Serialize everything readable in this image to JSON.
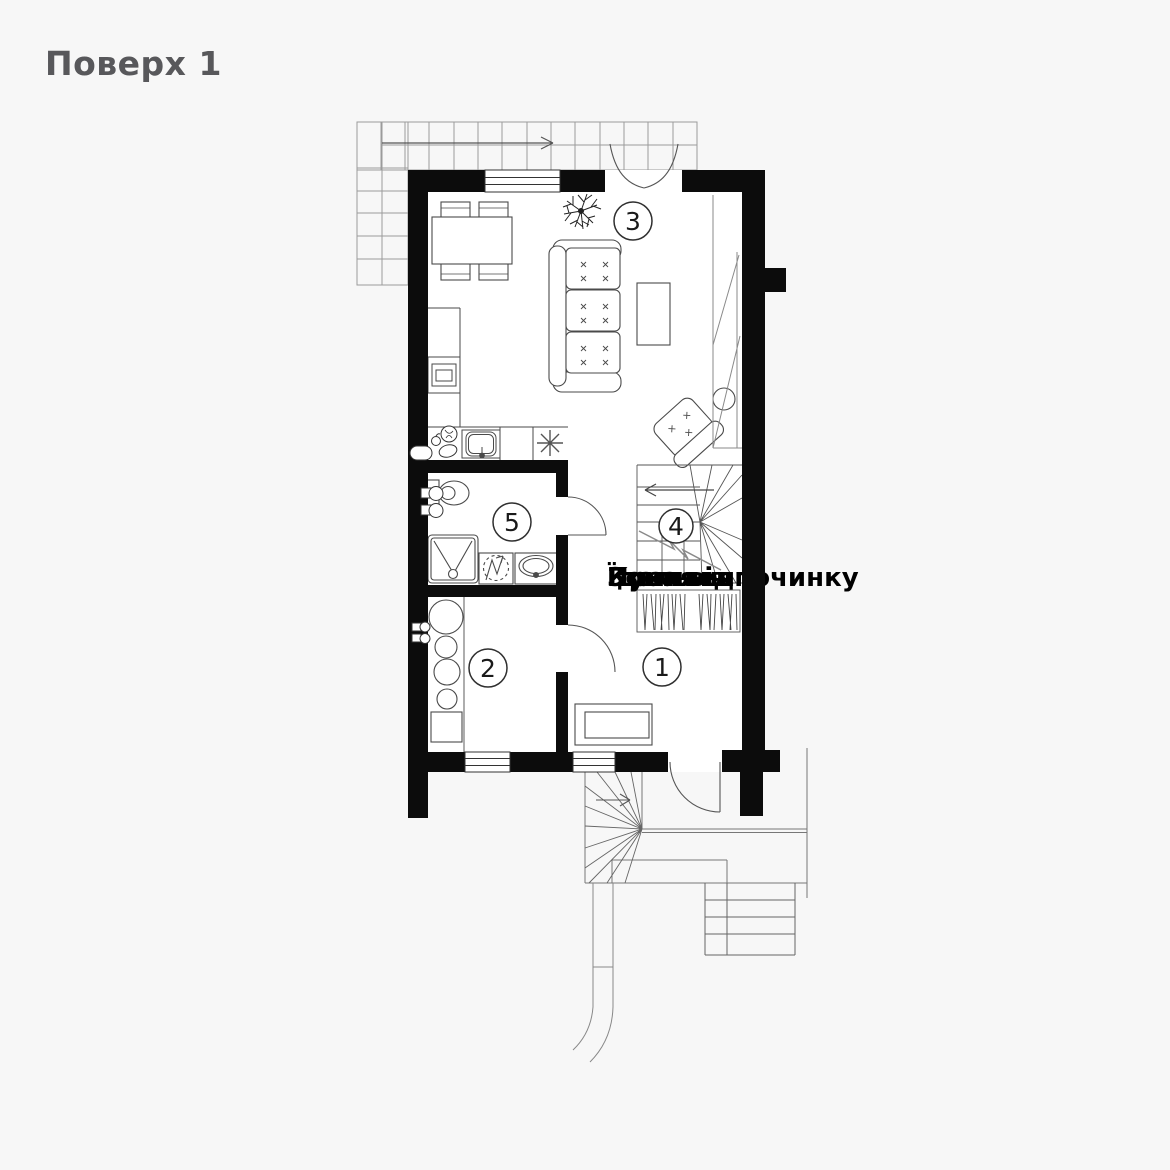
{
  "page": {
    "title": "Поверх 1",
    "background_color": "#f7f7f7",
    "floor_color": "#ffffff",
    "wall_color": "#0c0c0c",
    "line_color": "#4a4a4a",
    "title_color": "#58585b"
  },
  "plan": {
    "room_markers": [
      {
        "id": "room-1",
        "number": "1"
      },
      {
        "id": "room-2",
        "number": "2"
      },
      {
        "id": "room-3",
        "number": "3"
      },
      {
        "id": "room-4",
        "number": "4"
      },
      {
        "id": "room-5",
        "number": "5"
      }
    ],
    "overlapping_labels": [
      "Пральня",
      "Кухня",
      "Їдальня",
      "Зона відпочинку"
    ],
    "icons": {
      "stair_direction_arrow": "arrow-right",
      "terrace_grid": "tile-grid",
      "plant": "fern-plant",
      "hob": "asterisk-burner"
    }
  }
}
